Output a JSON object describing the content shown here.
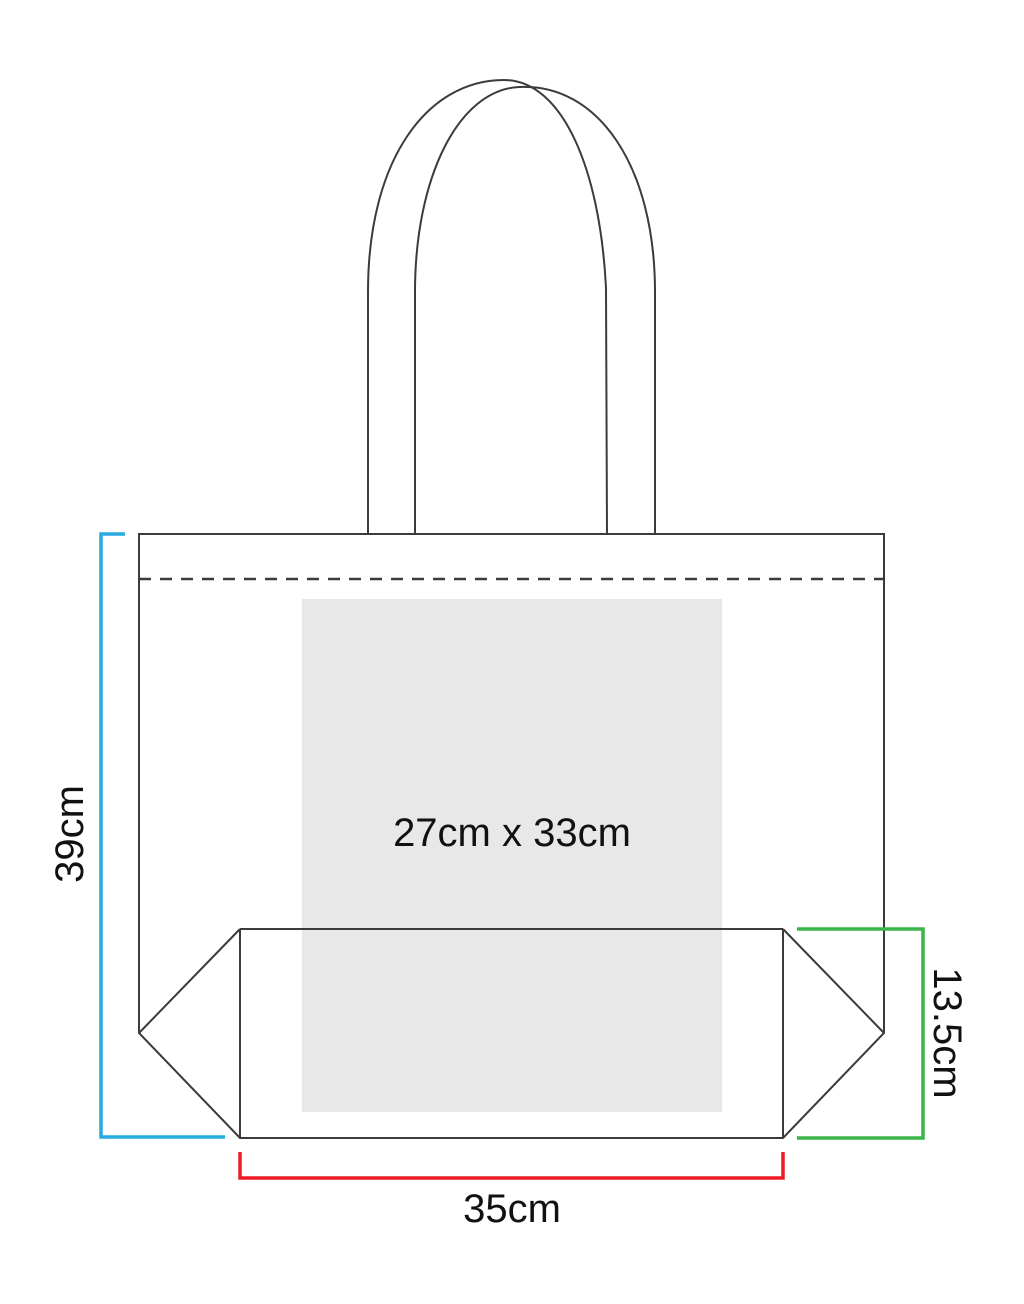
{
  "diagram": {
    "type": "tote-bag-dimension-diagram",
    "labels": {
      "bag_height": "39cm",
      "bag_width": "35cm",
      "gusset_depth": "13.5cm",
      "print_area": "27cm x 33cm"
    },
    "colors": {
      "outline": "#3B3B3B",
      "height_bracket": "#29ABE2",
      "width_bracket": "#ED1C24",
      "gusset_bracket": "#39B54A",
      "print_area_fill": "#E8E8E8",
      "label_text": "#111111"
    }
  }
}
